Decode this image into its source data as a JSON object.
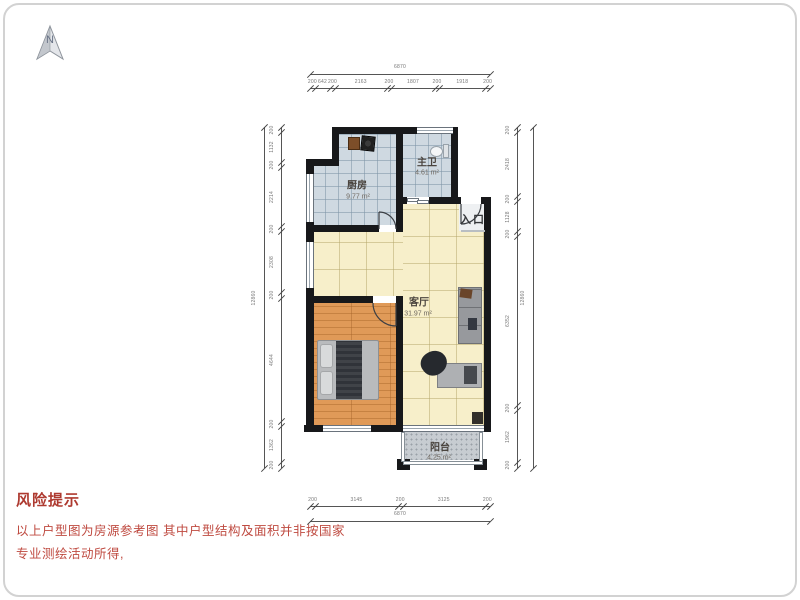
{
  "compass": {
    "label": "N"
  },
  "rooms": {
    "kitchen": {
      "name": "厨房",
      "area": "9.77 m²"
    },
    "bathroom": {
      "name": "主卫",
      "area": "4.61 m²"
    },
    "living": {
      "name": "客厅",
      "area": "31.97 m²"
    },
    "balcony": {
      "name": "阳台",
      "area": "4.25 m²"
    },
    "entrance": {
      "name": "入口"
    }
  },
  "dimensions": {
    "top": {
      "total": "6870",
      "segments": [
        200,
        642,
        200,
        2163,
        200,
        1807,
        200,
        1918,
        200
      ]
    },
    "bottom": {
      "total": "6870",
      "segments": [
        200,
        3145,
        200,
        3125,
        200
      ]
    },
    "left": {
      "total": "12860",
      "segments": [
        200,
        1132,
        200,
        2214,
        200,
        2308,
        200,
        4644,
        200,
        1362,
        200
      ]
    },
    "right": {
      "total": "12860",
      "segments": [
        200,
        2418,
        200,
        1128,
        200,
        6352,
        200,
        1962,
        200
      ]
    }
  },
  "warning": {
    "title": "风险提示",
    "line1": "以上户型图为房源参考图 其中户型结构及面积并非按国家",
    "line2": "专业测绘活动所得,"
  }
}
